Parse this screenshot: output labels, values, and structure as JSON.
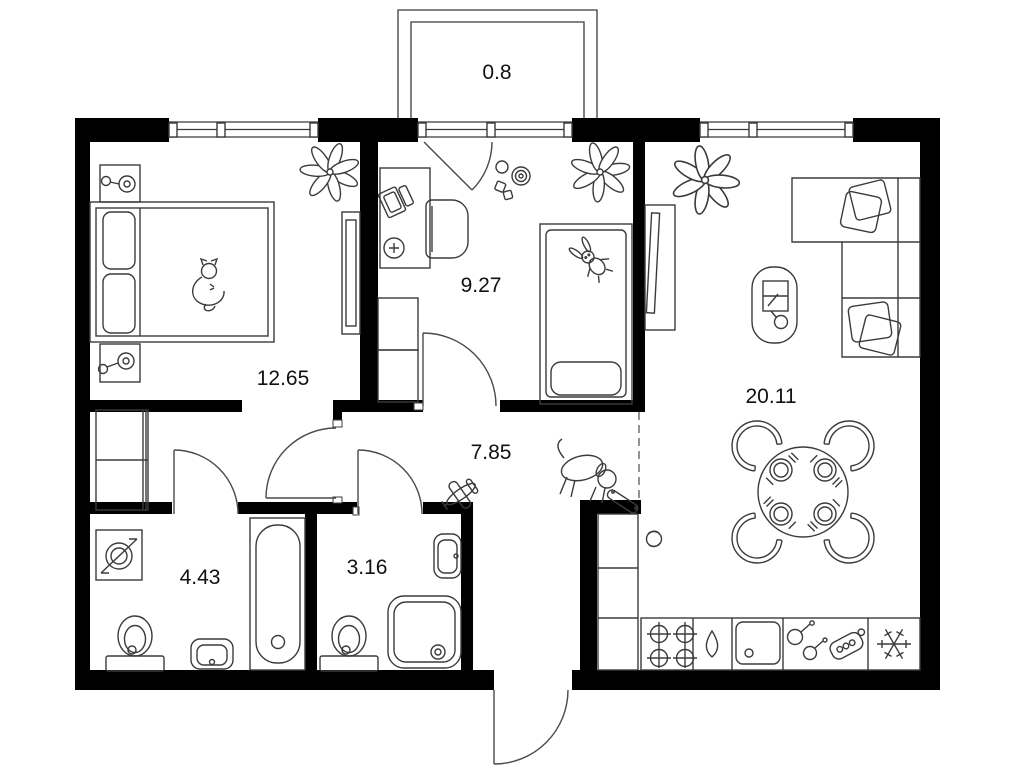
{
  "title": "apartment-floor-plan",
  "colors": {
    "wall": "#000000",
    "line": "#3b3b3b",
    "background": "#ffffff",
    "label": "#111111",
    "dashed": "#666666"
  },
  "rooms": {
    "balcony": {
      "name": "balcony",
      "area": "0.8"
    },
    "bedroom": {
      "name": "bedroom",
      "area": "12.65"
    },
    "kids_room": {
      "name": "kids-room",
      "area": "9.27"
    },
    "hallway": {
      "name": "hallway",
      "area": "7.85"
    },
    "bathroom": {
      "name": "bathroom",
      "area": "4.43"
    },
    "shower_room": {
      "name": "shower-room",
      "area": "3.16"
    },
    "living_kitchen": {
      "name": "living-kitchen",
      "area": "20.11"
    }
  }
}
